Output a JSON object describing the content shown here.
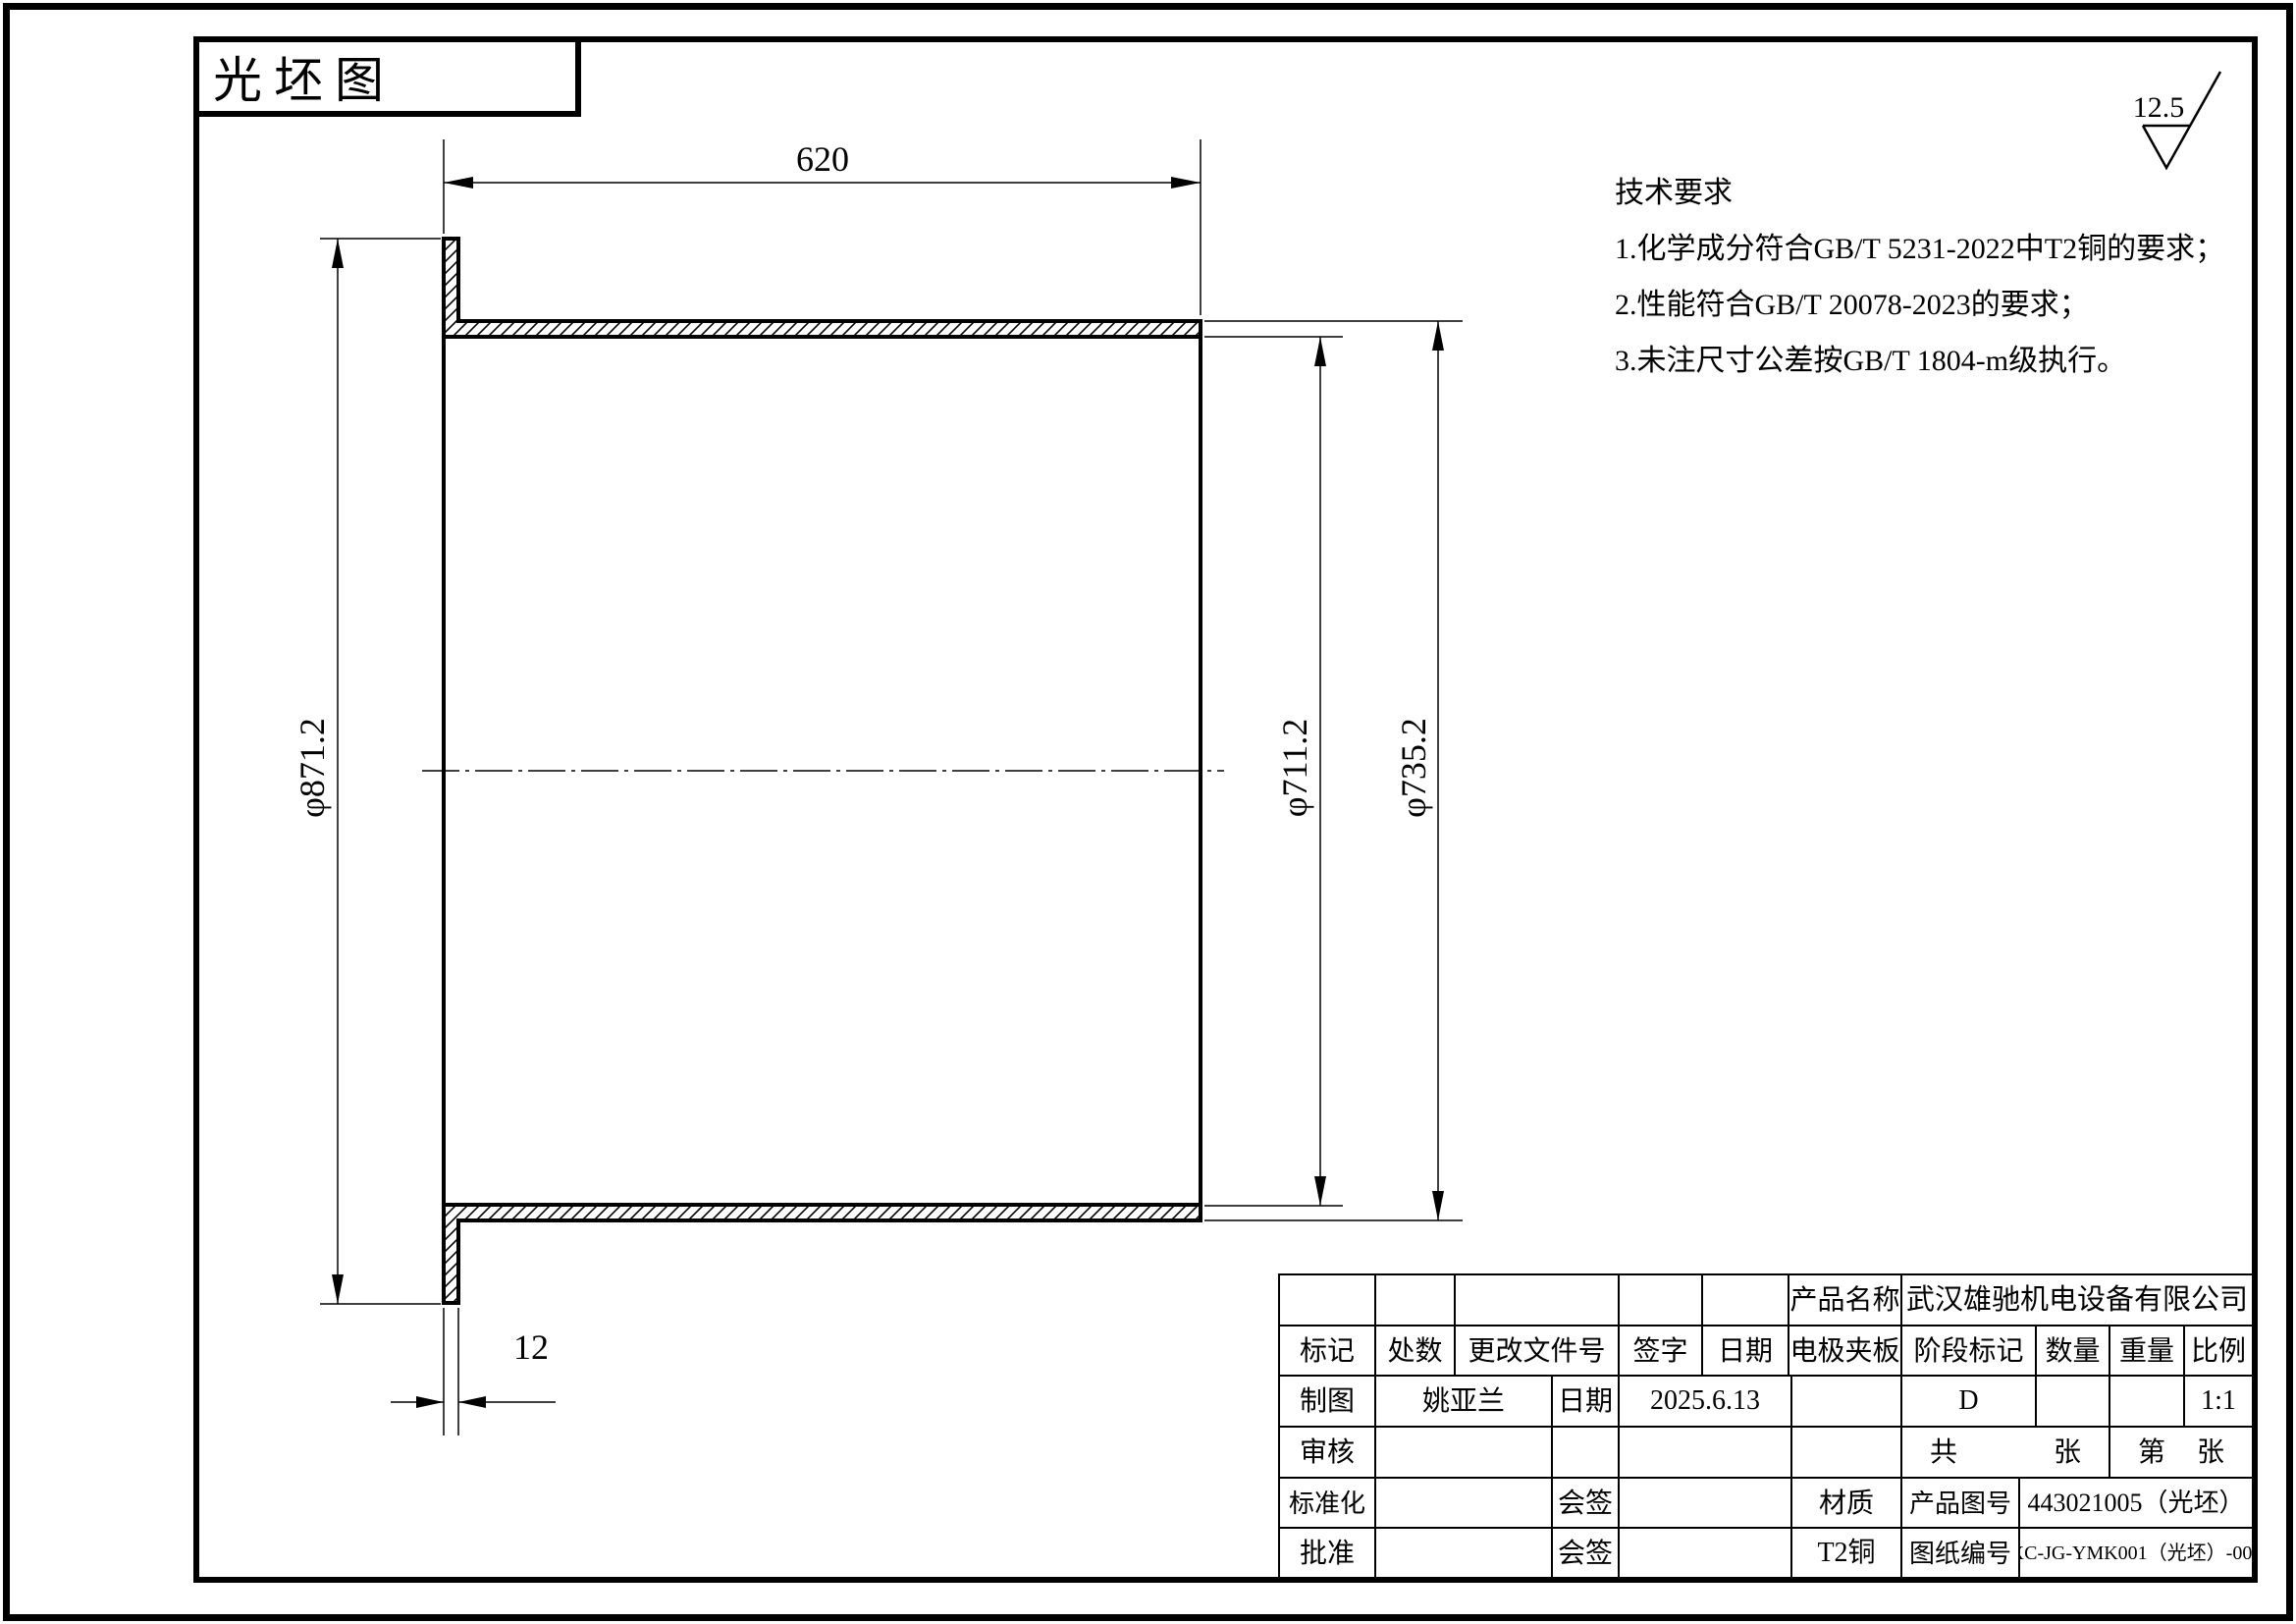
{
  "title_box": {
    "label": "光坯图"
  },
  "roughness": {
    "value": "12.5"
  },
  "tech_requirements": {
    "title": "技术要求",
    "items": [
      "1.化学成分符合GB/T 5231-2022中T2铜的要求；",
      "2.性能符合GB/T 20078-2023的要求；",
      "3.未注尺寸公差按GB/T 1804-m级执行。"
    ]
  },
  "dimensions": {
    "length": "620",
    "flange_diameter": "φ871.2",
    "bore_diameter": "φ711.2",
    "outer_diameter": "φ735.2",
    "flange_thickness": "12"
  },
  "title_block": {
    "product_name_label": "产品名称",
    "company": "武汉雄驰机电设备有限公司",
    "mark_label": "标记",
    "count_label": "处数",
    "change_doc_label": "更改文件号",
    "signature_label": "签字",
    "date_label": "日期",
    "product_name_value": "电极夹板",
    "stage_mark_label": "阶段标记",
    "quantity_label": "数量",
    "weight_label": "重量",
    "scale_label": "比例",
    "drafter_label": "制图",
    "drafter_name": "姚亚兰",
    "draft_date_label": "日期",
    "draft_date": "2025.6.13",
    "stage_value": "D",
    "scale_value": "1:1",
    "checker_label": "审核",
    "total_label": "共",
    "total_sheets_label": "张",
    "sheet_no_label": "第",
    "sheet_label": "张",
    "standardization_label": "标准化",
    "countersign_label_1": "会签",
    "countersign_label_2": "会签",
    "material_label": "材质",
    "material_value": "T2铜",
    "product_no_label": "产品图号",
    "product_no": "443021005（光坯）",
    "drawing_no_label": "图纸编号",
    "drawing_no": "XC-JG-YMK001（光坯）-005",
    "approver_label": "批准"
  }
}
